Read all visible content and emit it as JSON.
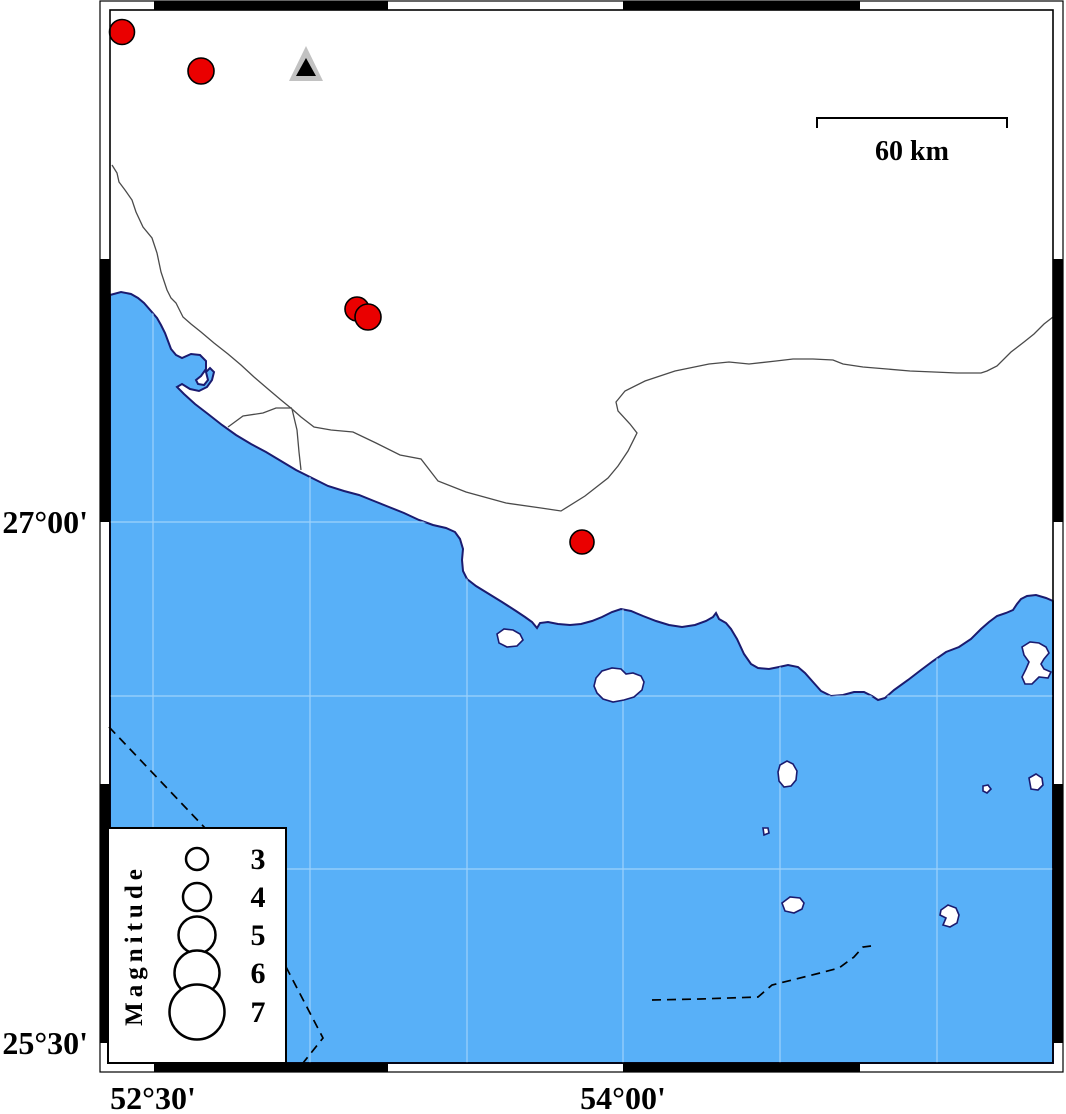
{
  "map_type": "seismicity-coastal-map",
  "colors": {
    "sea": "#58B0F8",
    "land": "#FFFFFF",
    "coastline": "#1B1B6F",
    "gridline": "#9ED2FB",
    "earthquake_fill": "#EA0000",
    "earthquake_stroke": "#000000",
    "station_outer": "#C2C2C2",
    "station_inner": "#000000",
    "frame": "#000000"
  },
  "axis": {
    "left": [
      {
        "text": "27°00'",
        "y": 522
      },
      {
        "text": "25°30'",
        "y": 1043
      }
    ],
    "bottom": [
      {
        "text": "52°30'",
        "x": 153
      },
      {
        "text": "54°00'",
        "x": 623
      }
    ]
  },
  "scalebar": {
    "label": "60 km",
    "x1": 817,
    "x2": 1007,
    "y": 118,
    "tick_drop": 10
  },
  "legend": {
    "title": "Magnitude",
    "box": {
      "x": 108,
      "y": 828,
      "w": 178,
      "h": 235
    },
    "circle_cx": 197,
    "label_x": 258,
    "items": [
      {
        "label": "3",
        "cy": 859,
        "r": 11
      },
      {
        "label": "4",
        "cy": 897,
        "r": 14
      },
      {
        "label": "5",
        "cy": 935,
        "r": 18.5
      },
      {
        "label": "6",
        "cy": 973,
        "r": 22.5
      },
      {
        "label": "7",
        "cy": 1012,
        "r": 27.5
      }
    ]
  },
  "map": {
    "earthquakes": [
      {
        "x": 122,
        "y": 32,
        "r": 12.5
      },
      {
        "x": 201,
        "y": 71,
        "r": 13
      },
      {
        "x": 357,
        "y": 309,
        "r": 12
      },
      {
        "x": 368,
        "y": 317,
        "r": 13
      },
      {
        "x": 582,
        "y": 542,
        "r": 12
      }
    ],
    "station": {
      "outer": "306,46 289,81 323,81",
      "inner": "306,58 296,76 316,76"
    },
    "gridlines": {
      "x": [
        153,
        310,
        467,
        623,
        780,
        937
      ],
      "y": [
        522,
        696,
        869
      ],
      "x_extent": [
        110,
        1053
      ],
      "y_extent": [
        10,
        1063
      ]
    },
    "frame": {
      "inner": {
        "x": 110,
        "y": 10,
        "w": 943,
        "h": 1053
      },
      "outer": {
        "x": 100,
        "y": 1,
        "w": 963,
        "h": 1071
      },
      "band": 10,
      "black_x_segments": [
        [
          154,
          388
        ],
        [
          623,
          860
        ]
      ],
      "black_y_segments": [
        [
          259,
          522
        ],
        [
          784,
          1043
        ]
      ]
    }
  }
}
